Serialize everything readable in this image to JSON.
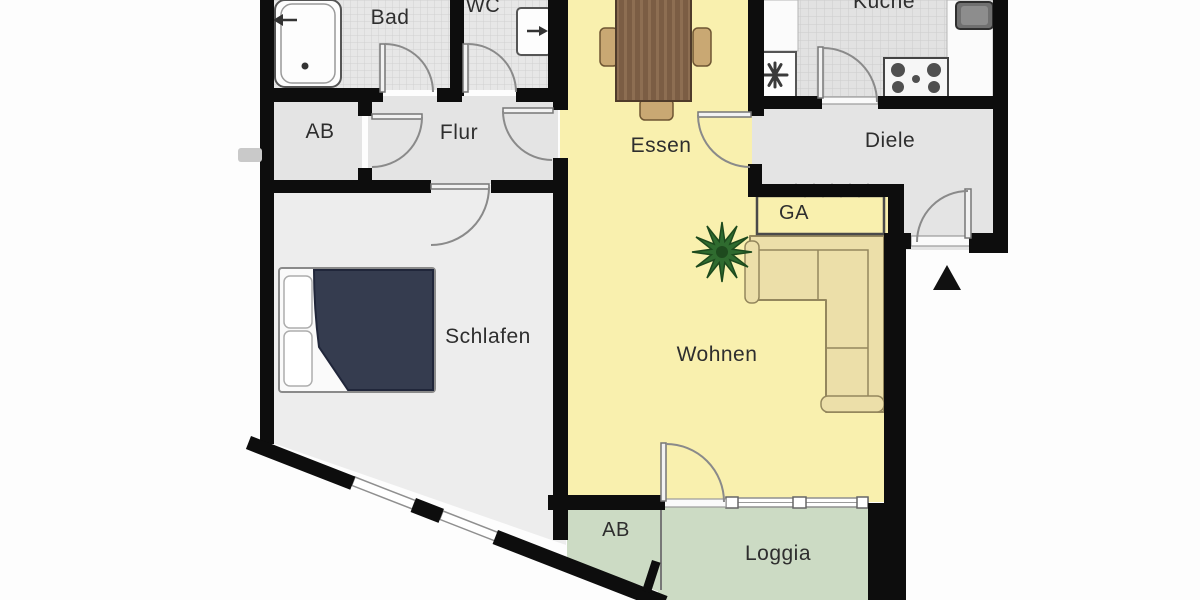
{
  "document": {
    "type": "apartment-floor-plan",
    "language": "de"
  },
  "rooms": {
    "bad": {
      "label": "Bad"
    },
    "wc": {
      "label": "WC"
    },
    "kueche": {
      "label": "Küche"
    },
    "ab_upper": {
      "label": "AB"
    },
    "flur": {
      "label": "Flur"
    },
    "essen": {
      "label": "Essen"
    },
    "diele": {
      "label": "Diele"
    },
    "ga": {
      "label": "GA"
    },
    "schlafen": {
      "label": "Schlafen"
    },
    "wohnen": {
      "label": "Wohnen"
    },
    "ab_lower": {
      "label": "AB"
    },
    "loggia": {
      "label": "Loggia"
    }
  },
  "colors": {
    "wall": "#0d0d0d",
    "hall_gray": "#e4e4e4",
    "bedroom_gray": "#ededed",
    "living_yellow": "#f9f0ae",
    "loggia_green": "#ccdbc4",
    "sofa_beige": "#ecdfa9",
    "bed_navy": "#353c4f",
    "plant_green": "#2f6b2f",
    "chair_wood": "#c9a873",
    "label_text": "#2e2e2e"
  },
  "fixtures": {
    "bathtub": "bathtub",
    "washbasin": "washbasin",
    "dishwasher_symbol": "asterisk",
    "kitchen_sink": "sink",
    "stove": "stove-4-burners",
    "dining_table": "dining-table",
    "dining_chairs": "chairs",
    "bed": "double-bed",
    "corner_sofa": "corner-sofa",
    "plant": "potted-plant",
    "wardrobe_hatch": "wardrobe",
    "entrance_marker": "triangle-arrow"
  }
}
